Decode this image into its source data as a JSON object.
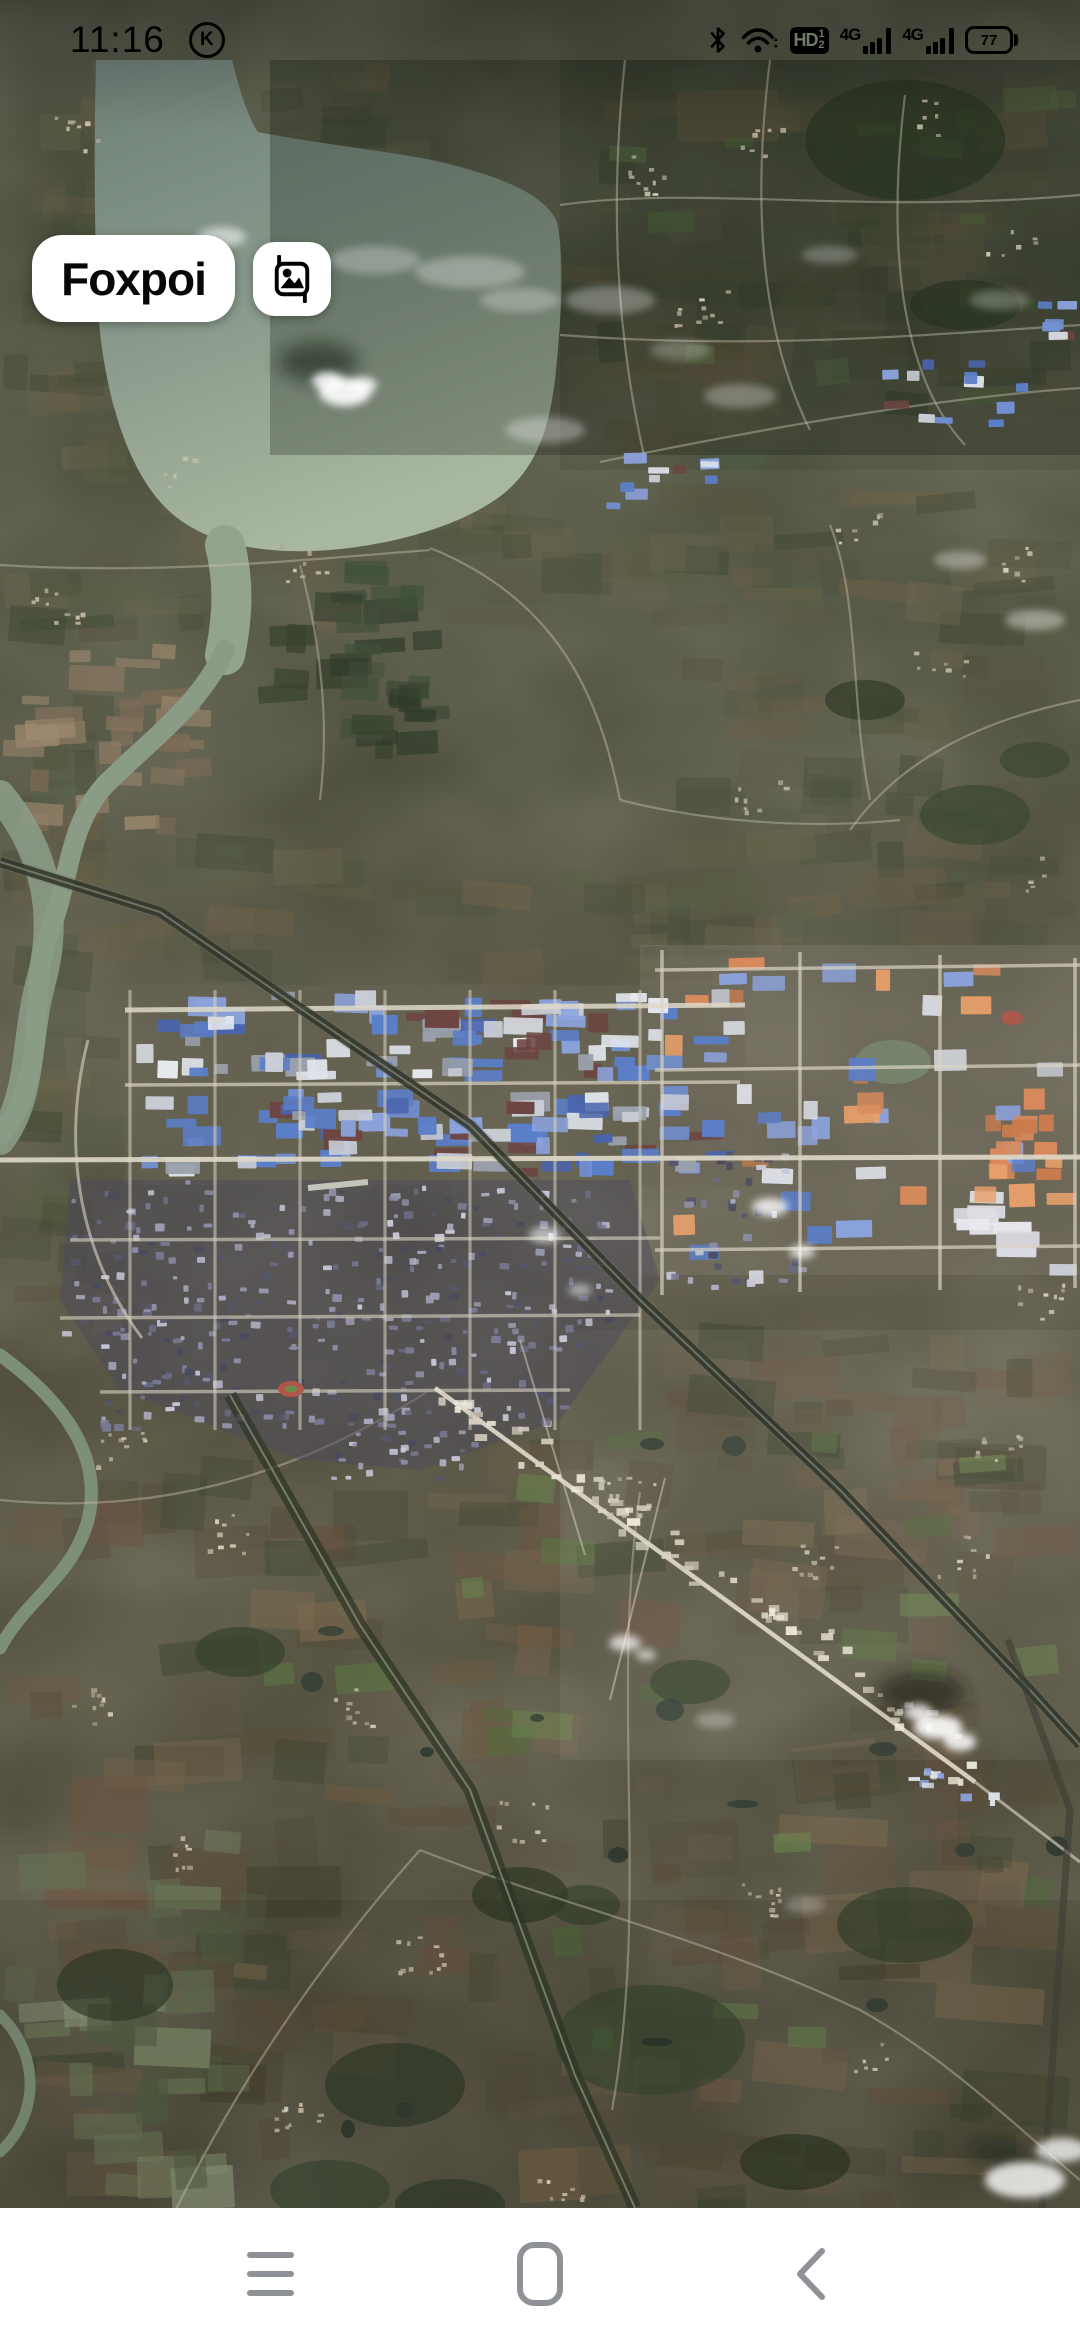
{
  "status_bar": {
    "time": "11:16",
    "notification_badge": "K",
    "volte_badge": {
      "label": "HD",
      "sim1": "1",
      "sim2": "2"
    },
    "sim1_network": "4G",
    "sim2_network": "4G",
    "battery_percent": "77",
    "icons": [
      "bluetooth-icon",
      "wifi-icon",
      "volte-hd-icon",
      "signal-sim1-icon",
      "signal-sim2-icon",
      "battery-icon"
    ]
  },
  "map": {
    "view_type": "satellite",
    "app_button_label": "Foxpoi",
    "image_button_icon": "image-crop-icon"
  },
  "nav_bar": {
    "buttons": [
      "menu",
      "home",
      "back"
    ]
  },
  "colors": {
    "button_bg": "#ffffff",
    "button_text": "#000000",
    "status_icons": "#000000",
    "nav_icons": "#8e9196",
    "nav_bar_bg": "#ffffff"
  }
}
